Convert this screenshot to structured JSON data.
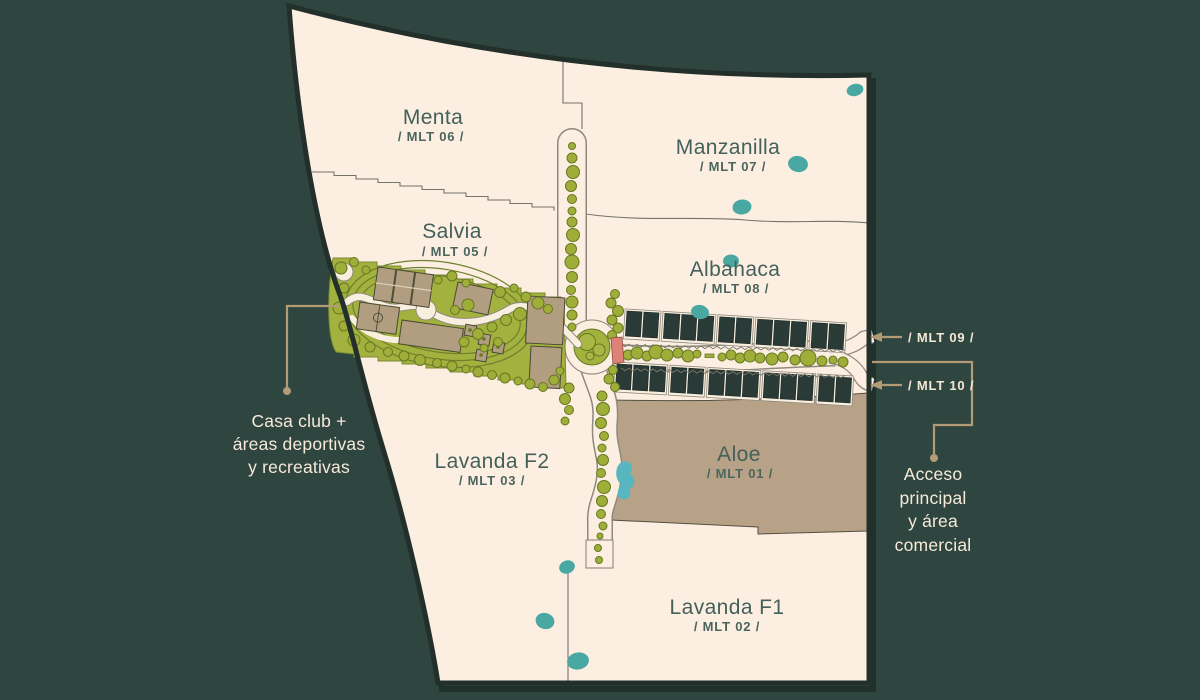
{
  "title": "Master plan site map",
  "colors": {
    "background": "#2f453f",
    "map_fill": "#fcefe2",
    "map_border": "#222f2a",
    "region_label": "#44605a",
    "park_green": "#a3b13e",
    "tree_green": "#9fae39",
    "tan_lot": "#b7a287",
    "housing_dark": "#2a3b37",
    "water_teal": "#4aa8a2",
    "water_blue": "#58b6c0",
    "crosswalk_pink": "#de8176",
    "callout_line": "#b39b76",
    "callout_text": "#f6ead9"
  },
  "map": {
    "regions": [
      {
        "name": "Menta",
        "code": "/ MLT 06 /"
      },
      {
        "name": "Manzanilla",
        "code": "/ MLT 07 /"
      },
      {
        "name": "Salvia",
        "code": "/ MLT 05 /"
      },
      {
        "name": "Albahaca",
        "code": "/ MLT 08 /"
      },
      {
        "name": "Aloe",
        "code": "/ MLT 01 /"
      },
      {
        "name": "Lavanda F2",
        "code": "/ MLT 03 /"
      },
      {
        "name": "Lavanda F1",
        "code": "/ MLT 02 /"
      }
    ]
  },
  "callouts": {
    "casa_club": {
      "lines": [
        "Casa club +",
        "áreas deportivas",
        "y recreativas"
      ]
    },
    "acceso": {
      "lines": [
        "Acceso",
        "principal",
        "y área",
        "comercial"
      ]
    },
    "mlt09": "/ MLT 09 /",
    "mlt10": "/ MLT 10 /"
  }
}
